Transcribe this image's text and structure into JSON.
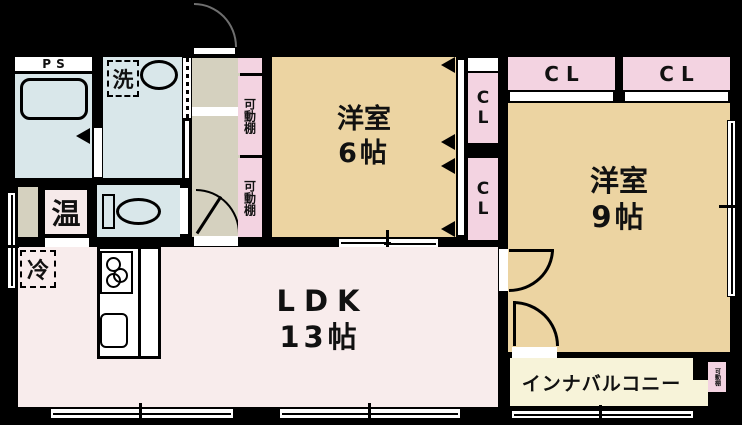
{
  "rooms": {
    "ps": {
      "label": "PS"
    },
    "laundry": {
      "label": "洗"
    },
    "water_heater": {
      "label": "温"
    },
    "fridge": {
      "label": "冷"
    },
    "shelf_upper": {
      "label": "可動棚"
    },
    "shelf_lower": {
      "label": "可動棚"
    },
    "western6": {
      "name": "洋室",
      "size": "6帖"
    },
    "western9": {
      "name": "洋室",
      "size": "9帖"
    },
    "ldk": {
      "name": "LDK",
      "size": "13帖"
    },
    "closet_side_upper": {
      "label": "CL"
    },
    "closet_side_lower": {
      "label": "CL"
    },
    "closet_top_left": {
      "label": "CL"
    },
    "closet_top_right": {
      "label": "CL"
    },
    "balcony": {
      "label": "インナバルコニー"
    },
    "balcony_shelf": {
      "label": "可動棚"
    }
  },
  "colors": {
    "wall": "#000000",
    "wet_room": "#d9e7ea",
    "hallway": "#d5d1bf",
    "western_room": "#ecd4a2",
    "closet_pink": "#f3d3e1",
    "ldk": "#f8ecec",
    "balcony": "#f7f3d9",
    "heater_box": "#f6eaea",
    "door": "#ffffff"
  }
}
